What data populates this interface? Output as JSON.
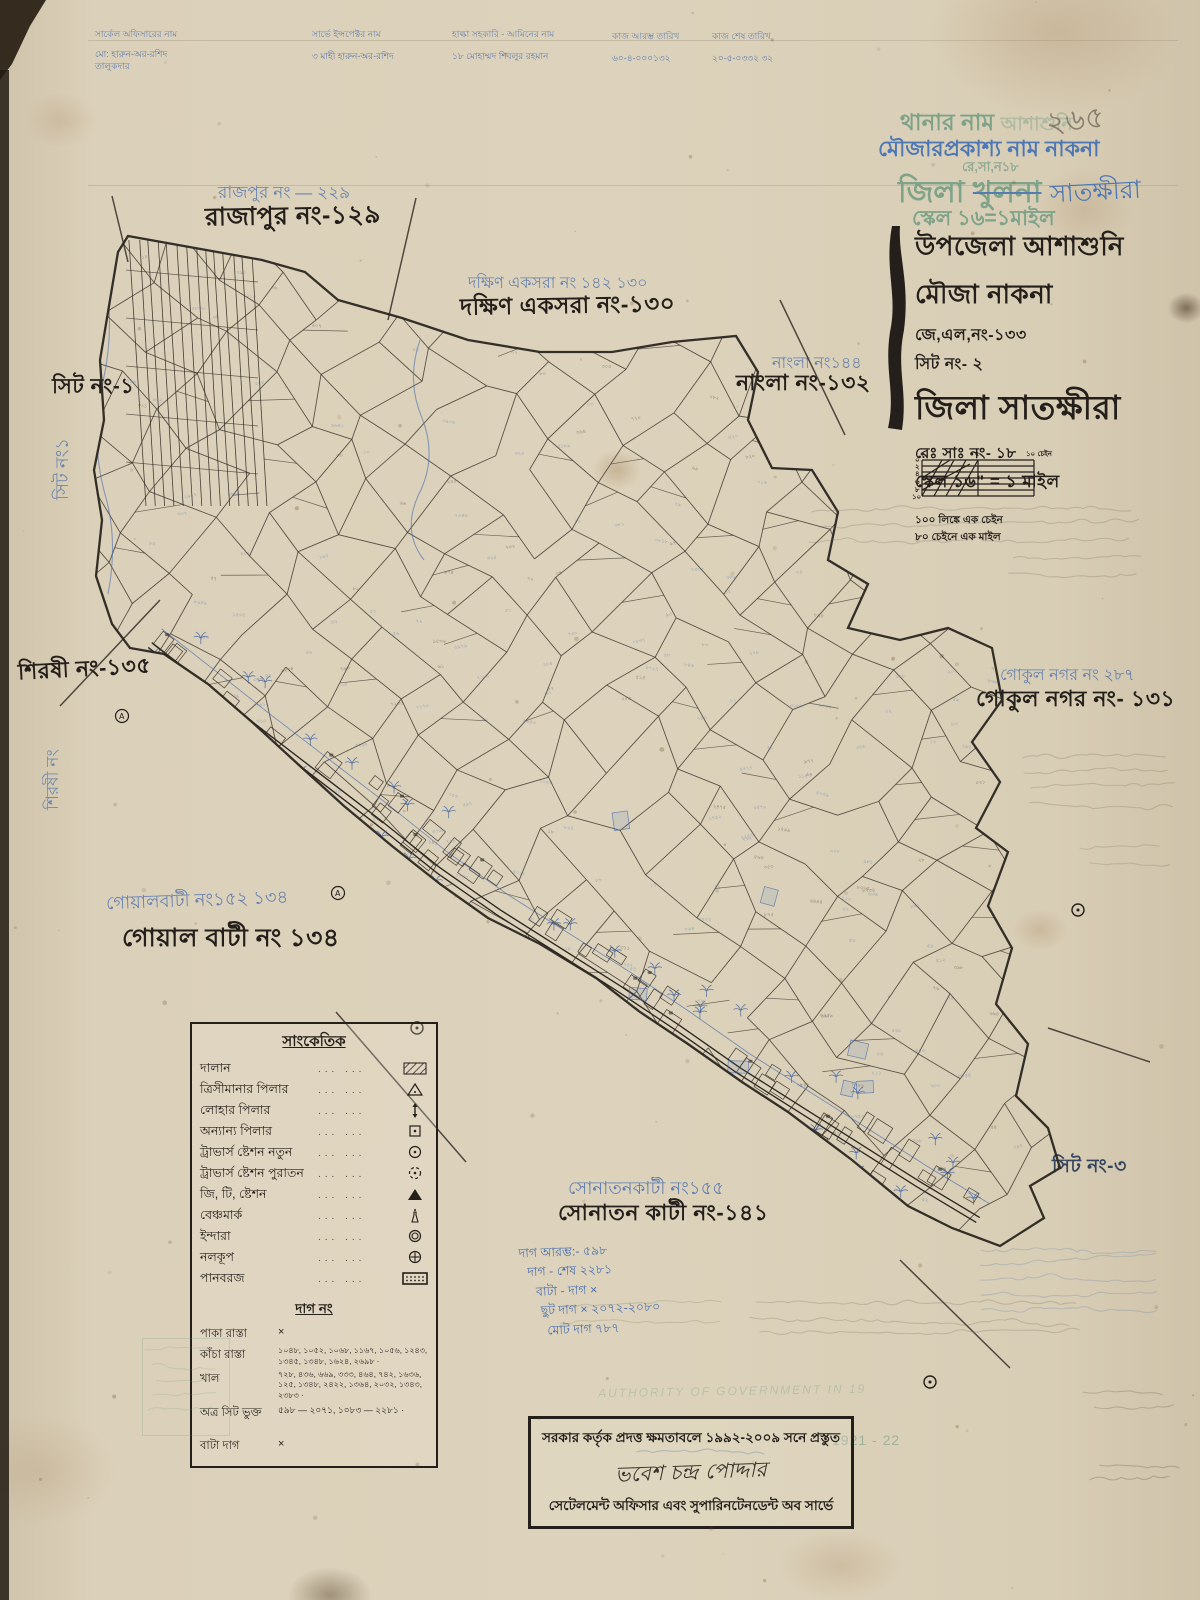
{
  "colors": {
    "paper": "#d8cdb6",
    "ink": "#241f1a",
    "blue_ink": "#4a6fae",
    "stamp_green": "#6f9c82",
    "stamp_blue": "#3f6fb5",
    "pencil": "#6f6557"
  },
  "header_table": {
    "columns": [
      {
        "title": "সার্কেল অফিসারের নাম",
        "value": "মো: হারুন-অর-রশিদ\nতালুকদার"
      },
      {
        "title": "সার্ভে ইন্সপেক্টর নাম",
        "value": "৩ মাহী হারুন-অর-রশিদ"
      },
      {
        "title": "হাল্কা সহকারি - আমিনের নাম",
        "value": "১৮ মোহাম্মদ শিবলুর রহমান"
      },
      {
        "title": "কাজ আরম্ভ তারিখ",
        "value": "৬০-৪-০০০১৩২"
      },
      {
        "title": "কাজ শেষ তারিখ",
        "value": "২০-৫-০৩৩২ ৩২"
      }
    ]
  },
  "stamps": {
    "thana_label": "থানার নাম",
    "thana_faint": "আশাশুনি",
    "pencil_no": "২৬৫",
    "mouza_line": "মৌজারপ্রকাশ্য নাম নাকনা",
    "resa_line": "রে,সা,ন১৮",
    "zila_label": "জিলা",
    "zila_old": "খুলনা",
    "zila_new": "সাতক্ষীরা",
    "scale_line": "স্কেল ১৬=১মাইল"
  },
  "title_block": {
    "upazila": "উপজেলা আশাশুনি",
    "mouza": "মৌজা নাকনা",
    "jl_no": "জে,এল,নং-১৩৩",
    "sheet_no": "সিট নং- ২",
    "zila": "জিলা সাতক্ষীরা",
    "re_sa_no": "রেঃ সাঃ নং- ১৮",
    "scale": "স্কেল ১৬\" = ১ মাইল",
    "conv1": "১০০ লিঙ্কে এক চেইন",
    "conv2": "৮০ চেইনে এক মাইল",
    "scalebar": {
      "left_ticks": [
        "০",
        "২",
        "৪",
        "৬",
        "৮",
        "১০"
      ],
      "top_zero": "০",
      "top_mid": "৫",
      "top_right": "১০ চেইন"
    }
  },
  "labels": {
    "rajpur_blue": "রাজপুর নং — ২২৯",
    "rajpur_black": "রাজাপুর নং-১২৯",
    "dakshin_blue": "দক্ষিণ একসরা নং ১৪২  ১৩০",
    "dakshin_black": "দক্ষিণ একসরা নং-১৩০",
    "nangla_blue": "নাংলা নং১৪৪",
    "nangla_black": "নাংলা নং-১৩২",
    "sheet1_black": "সিট নং-১",
    "sheet1_blue": "সিট নং১",
    "shirshi_black": "শিরষী নং-১৩৫",
    "shirshi_blue": "শিরষী নং",
    "gokul_blue": "গোকুল নগর নং  ২৮৭",
    "gokul_black": "গোকুল নগর নং- ১৩১",
    "goyal_blue": "গোয়ালবাটী নং১৫২  ১৩৪",
    "goyal_black": "গোয়াল বাটী নং ১৩৪",
    "sonatan_blue": "সোনাতনকাটী নং১৫৫",
    "sonatan_black": "সোনাতন কাটী নং-১৪১",
    "sheet3_black": "সিট নং-৩"
  },
  "legend": {
    "title": "সাংকেতিক",
    "dots": "...   ...",
    "rows": [
      {
        "label": "দালান",
        "symbol": "building-hatch"
      },
      {
        "label": "ত্রিসীমানার পিলার",
        "symbol": "open-triangle"
      },
      {
        "label": "লোহার পিলার",
        "symbol": "iron-pillar-arrow"
      },
      {
        "label": "অন্যান্য পিলার",
        "symbol": "square-dot"
      },
      {
        "label": "ট্রাভার্স ষ্টেশন নতুন",
        "symbol": "circle-dot"
      },
      {
        "label": "ট্রাভার্স ষ্টেশন পুরাতন",
        "symbol": "dashed-circle-dot"
      },
      {
        "label": "জি, টি, ষ্টেশন",
        "symbol": "filled-triangle"
      },
      {
        "label": "বেঞ্চমার্ক",
        "symbol": "benchmark-bottle"
      },
      {
        "label": "ইন্দারা",
        "symbol": "double-circle"
      },
      {
        "label": "নলকূপ",
        "symbol": "circle-plus"
      },
      {
        "label": "পানবরজ",
        "symbol": "dotted-rect"
      }
    ],
    "dag_title": "দাগ নং",
    "dag_rows": [
      {
        "label": "পাকা রাস্তা",
        "value": "×"
      },
      {
        "label": "কাঁচা রাস্তা",
        "value": "১০৪৮, ১০৫২, ১০৬৮, ১১৬৭, ১০৫৬, ১২৪৩, ১৩৪৫, ১৩৪৮, ১৬২৪, ২৬৯৮ ·"
      },
      {
        "label": "খাল",
        "value": "৭২৮, ৪৩৬, ৬৬৯, ৩৩৩, ৪৬৪, ৭৪২, ১৬৩৬, ১২৫, ১৩৪৮, ২৪২২, ১৩৬৪, ২০৩২, ১৩৪৩, ২৩৮৩ ·"
      },
      {
        "label": "অত্র সিট ভুক্ত",
        "value": "৫৯৮ — ২০৭১,  ১০৮৩ — ২২৮১ ·"
      },
      {
        "label": "বাটা দাগ",
        "value": "×"
      }
    ],
    "notes_blue": [
      "দাগ আরম্ভ:- ৫৯৮",
      "দাগ - শেষ ২২৮১",
      "বাটা - দাগ   ×",
      "ছুট দাগ   ×  ২০৭২-২০৮০",
      "মোট দাগ ৭৮৭"
    ]
  },
  "footer_stamp": {
    "line1": "সরকার কর্তৃক প্রদত্ত ক্ষমতাবলে ১৯৯২-২০০৯ সনে প্রস্তুত",
    "signature": "ভবেশ চন্দ্র পোদ্দার",
    "line2": "সেটেলমেন্ট অফিসার এবং সুপারিনটেনডেন্ট অব সার্ভে"
  },
  "misc": {
    "faint_english": "AUTHORITY OF GOVERNMENT IN 19",
    "green_year": "1921 - 22"
  }
}
